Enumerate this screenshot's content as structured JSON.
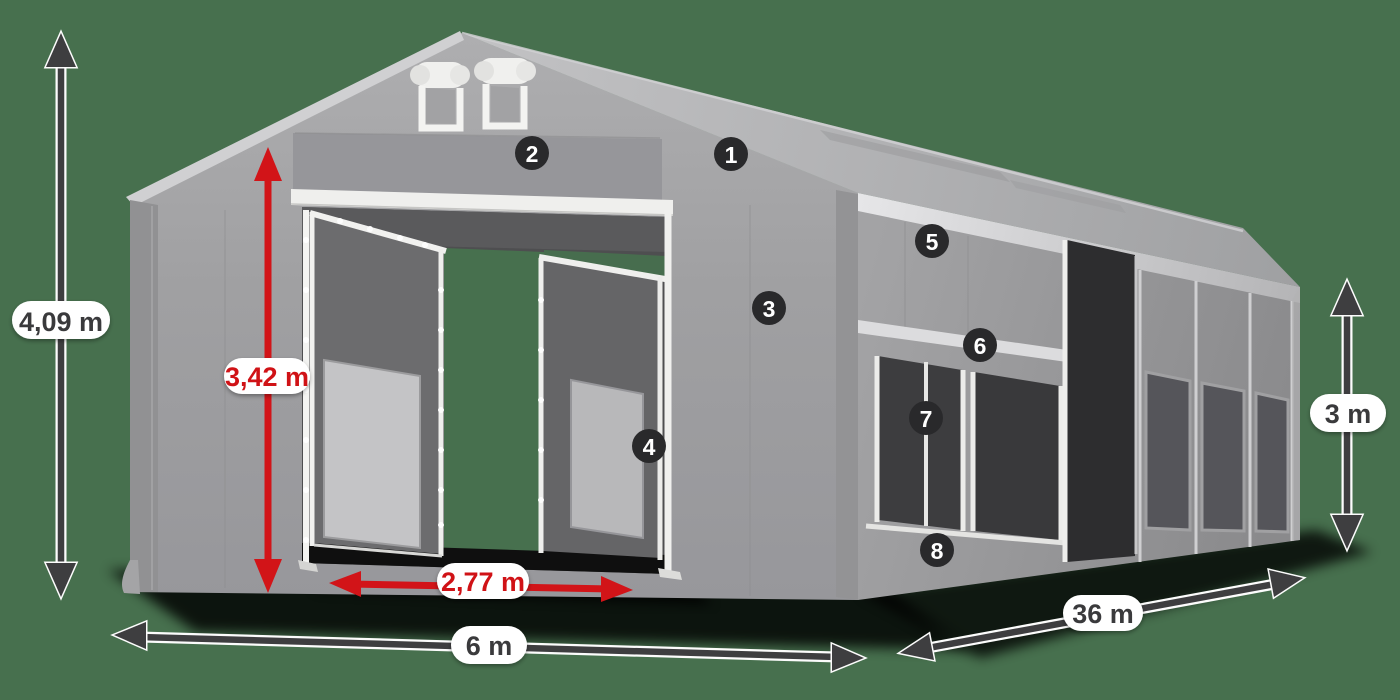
{
  "scene": {
    "subject": "tent-dimension-diagram"
  },
  "colors": {
    "background": "#47704E",
    "tent_light": "#c0c0c2",
    "tent_mid": "#9c9c9e",
    "tent_dark": "#3a3a3c",
    "frame_white": "#f0f0ee",
    "arrow_dark": "#3e3e40",
    "accent_red": "#d21418",
    "red_text": "#d01216",
    "badge_bg": "#29292b",
    "badge_text": "#ffffff",
    "label_bg": "#ffffff",
    "label_text": "#3a3a3c"
  },
  "dimensions": {
    "total_height": {
      "label": "4,09 m"
    },
    "entrance_height": {
      "label": "3,42 m"
    },
    "entrance_width": {
      "label": "2,77 m"
    },
    "width": {
      "label": "6 m"
    },
    "length": {
      "label": "36 m"
    },
    "side_height": {
      "label": "3 m"
    }
  },
  "callouts": [
    {
      "number": "1"
    },
    {
      "number": "2"
    },
    {
      "number": "3"
    },
    {
      "number": "4"
    },
    {
      "number": "5"
    },
    {
      "number": "6"
    },
    {
      "number": "7"
    },
    {
      "number": "8"
    }
  ]
}
